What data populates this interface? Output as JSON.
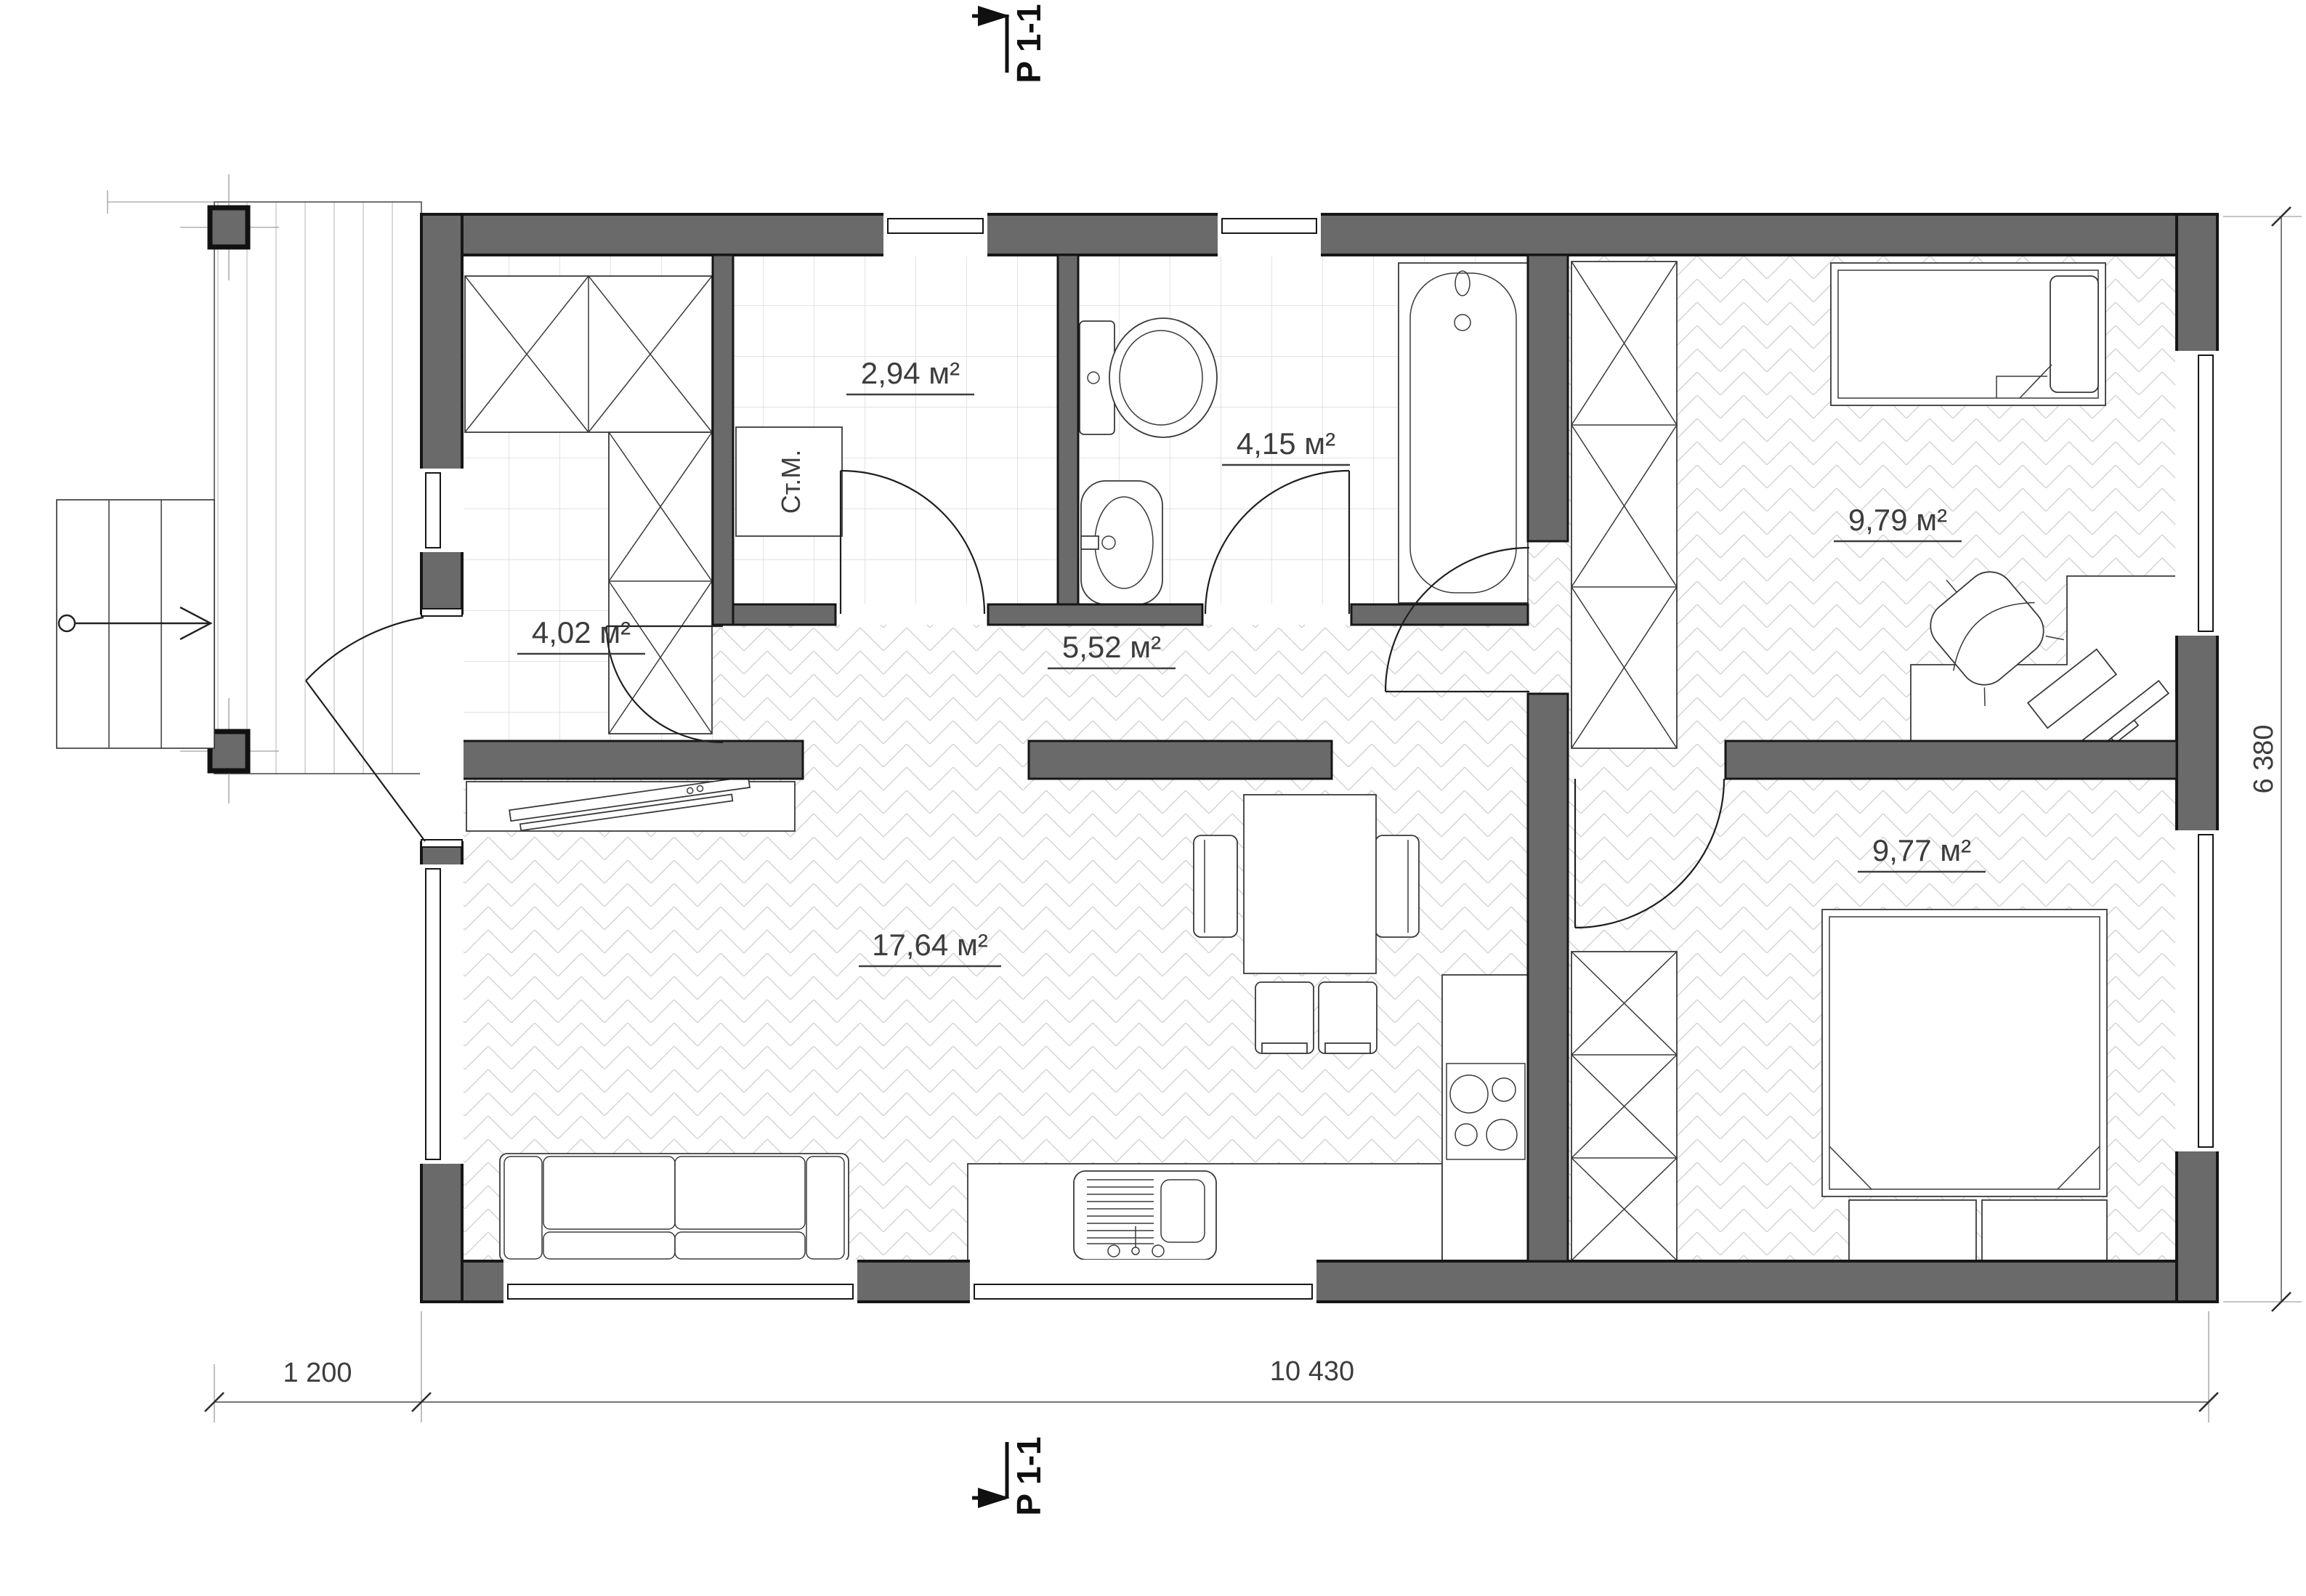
{
  "plan": {
    "section_marker": {
      "label": "P 1-1"
    },
    "rooms": [
      {
        "id": "entry",
        "area_label": "4,02 м²"
      },
      {
        "id": "laundry",
        "area_label": "2,94 м²"
      },
      {
        "id": "bathroom",
        "area_label": "4,15 м²"
      },
      {
        "id": "hall",
        "area_label": "5,52 м²"
      },
      {
        "id": "living_kitchen",
        "area_label": "17,64 м²"
      },
      {
        "id": "bedroom_top",
        "area_label": "9,79 м²"
      },
      {
        "id": "bedroom_bottom",
        "area_label": "9,77 м²"
      }
    ],
    "appliances": {
      "washing_machine": "Ст.М."
    },
    "dimensions": {
      "porch_width": "1 200",
      "house_width": "10 430",
      "house_depth": "6 380"
    },
    "colors": {
      "wall": "#6a6a6a",
      "outline": "#161616",
      "label_text": "#3d3d3d"
    }
  }
}
